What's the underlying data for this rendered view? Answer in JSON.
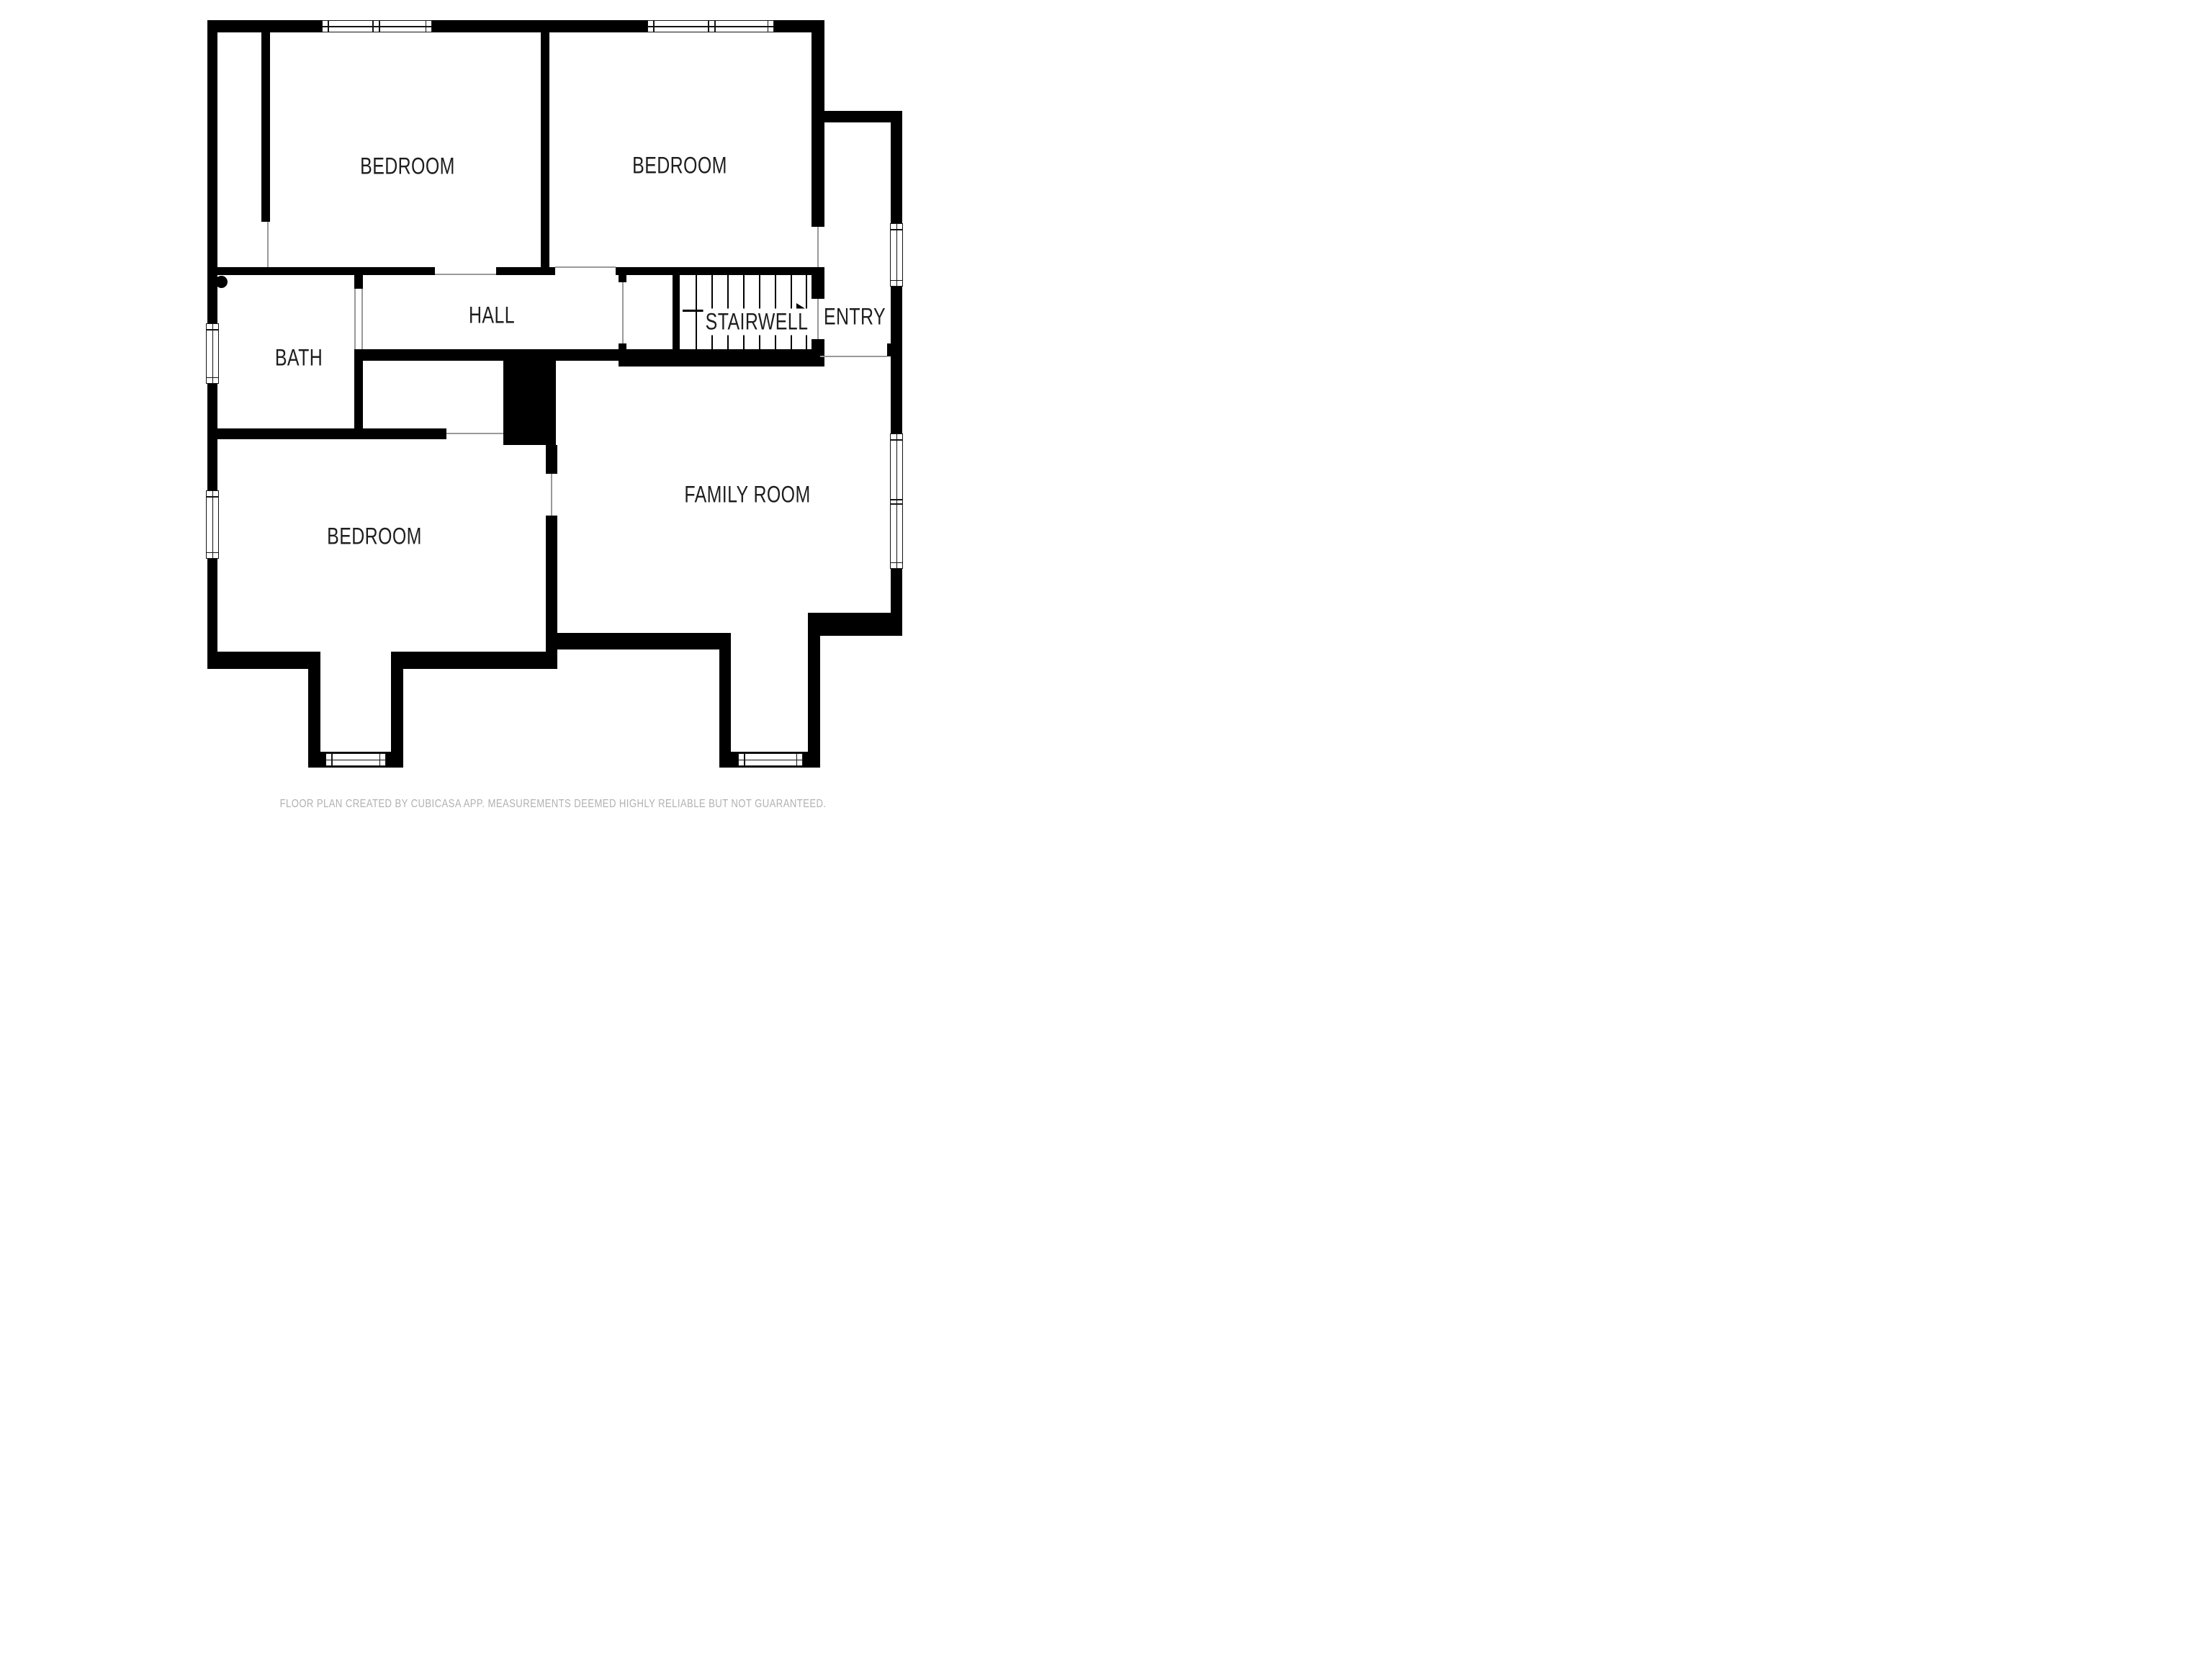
{
  "rooms": {
    "bedroom_top_left": {
      "label": "BEDROOM"
    },
    "bedroom_top_right": {
      "label": "BEDROOM"
    },
    "hall": {
      "label": "HALL"
    },
    "stairwell": {
      "label": "STAIRWELL"
    },
    "entry": {
      "label": "ENTRY"
    },
    "bath": {
      "label": "BATH"
    },
    "bedroom_bottom": {
      "label": "BEDROOM"
    },
    "family_room": {
      "label": "FAMILY ROOM"
    }
  },
  "footer": {
    "disclaimer": "FLOOR PLAN CREATED BY CUBICASA APP. MEASUREMENTS DEEMED HIGHLY RELIABLE BUT NOT GUARANTEED."
  },
  "colors": {
    "wall": "#000000",
    "label_text": "#1e1e1e",
    "door_opening_line": "#9a9a9a",
    "disclaimer_text": "#b1b1b1",
    "background": "#ffffff"
  }
}
